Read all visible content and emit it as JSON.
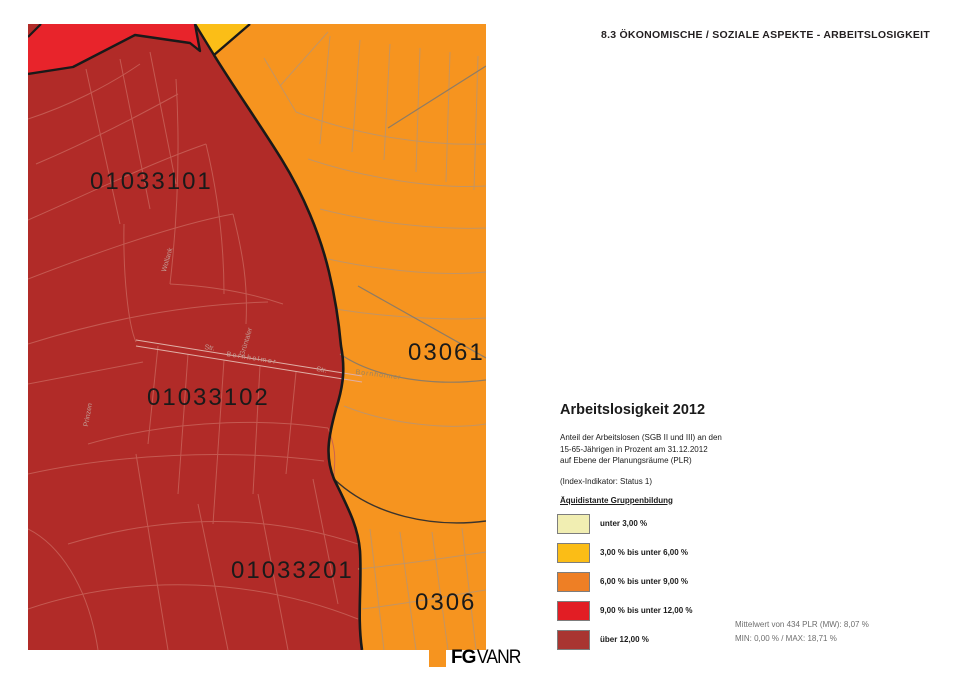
{
  "header": {
    "title": "8.3 ÖKONOMISCHE / SOZIALE ASPEKTE - ARBEITSLOSIGKEIT"
  },
  "map": {
    "region_labels": [
      {
        "text": "01033101"
      },
      {
        "text": "01033102"
      },
      {
        "text": "01033201"
      },
      {
        "text": "03061"
      },
      {
        "text": "0306"
      }
    ],
    "street_labels": [
      {
        "text": "Str."
      },
      {
        "text": "Bornholmer"
      },
      {
        "text": "Str."
      },
      {
        "text": "Bornholmer"
      },
      {
        "text": "Grüntaler"
      },
      {
        "text": "Wollank"
      },
      {
        "text": "Prinzen"
      }
    ],
    "colors": {
      "over_12": "#B12B28",
      "class_9_12": "#E8242B",
      "class_6_9": "#F6941F",
      "class_3_6": "#FBBE17",
      "boundary": "#191919"
    }
  },
  "legend": {
    "title": "Arbeitslosigkeit 2012",
    "description_lines": [
      "Anteil der Arbeitslosen (SGB II und III) an den",
      "15-65-Jährigen in Prozent am 31.12.2012",
      "auf Ebene der Planungsräume (PLR)"
    ],
    "indicator_note": "(Index-Indikator: Status 1)",
    "grouping_heading": "Äquidistante Gruppenbildung",
    "classes": [
      {
        "label": "unter 3,00 %",
        "color": "#F1EEB2"
      },
      {
        "label": "3,00 % bis unter 6,00 %",
        "color": "#FBBD16"
      },
      {
        "label": "6,00 % bis unter 9,00 %",
        "color": "#EE7F25"
      },
      {
        "label": "9,00 % bis unter 12,00 %",
        "color": "#E21D24"
      },
      {
        "label": "über 12,00 %",
        "color": "#A93531"
      }
    ],
    "stats": {
      "line1": "Mittelwert von 434 PLR (MW): 8,07 %",
      "line2": "MIN: 0,00 % / MAX: 18,71 %"
    }
  },
  "footer": {
    "logo_bold": "FG",
    "logo_rest": "VANR"
  }
}
